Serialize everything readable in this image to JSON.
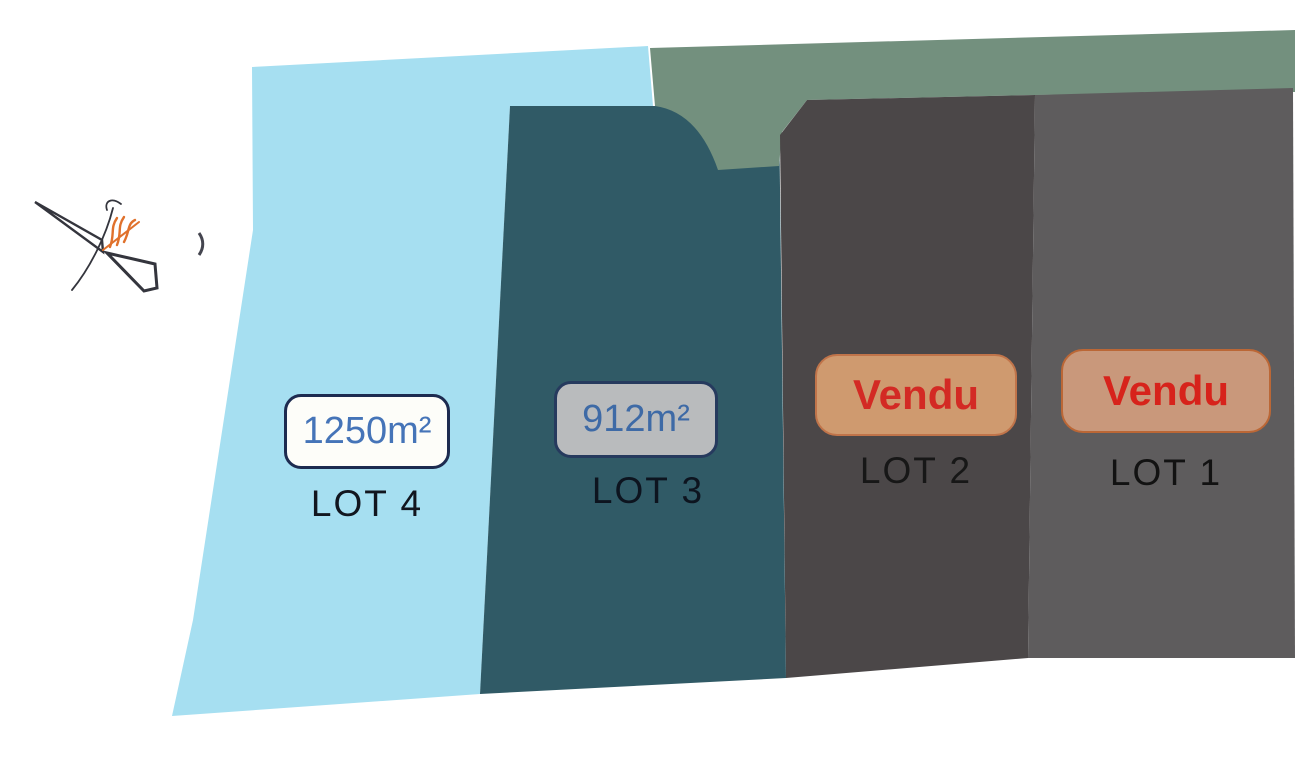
{
  "compass": {
    "ink_color": "#34353d",
    "accent_color": "#e0712c"
  },
  "tick_mark_color": "#44454f",
  "green_area": {
    "fill": "#73907e"
  },
  "lots": {
    "lot4": {
      "label": "LOT 4",
      "area": "1250m²",
      "fill": "#a6dff1",
      "badge_bg": "#fdfdf9",
      "badge_border": "#1d2b50",
      "area_text_color": "#4574b8",
      "label_color": "#12161f"
    },
    "lot3": {
      "label": "LOT 3",
      "area": "912m²",
      "fill": "#305a66",
      "badge_bg": "#b9bbbd",
      "badge_border": "#263a5e",
      "area_text_color": "#3e6aa6",
      "label_color": "#0d141f"
    },
    "lot2": {
      "label": "LOT 2",
      "status": "Vendu",
      "fill": "#4b4748",
      "badge_bg": "#cf9a6f",
      "badge_border": "#c0744a",
      "status_text_color": "#d32a24",
      "label_color": "#171717"
    },
    "lot1": {
      "label": "LOT 1",
      "status": "Vendu",
      "fill": "#5e5c5d",
      "badge_bg": "#c9987b",
      "badge_border": "#bb6736",
      "status_text_color": "#d7231b",
      "label_color": "#121212"
    }
  }
}
